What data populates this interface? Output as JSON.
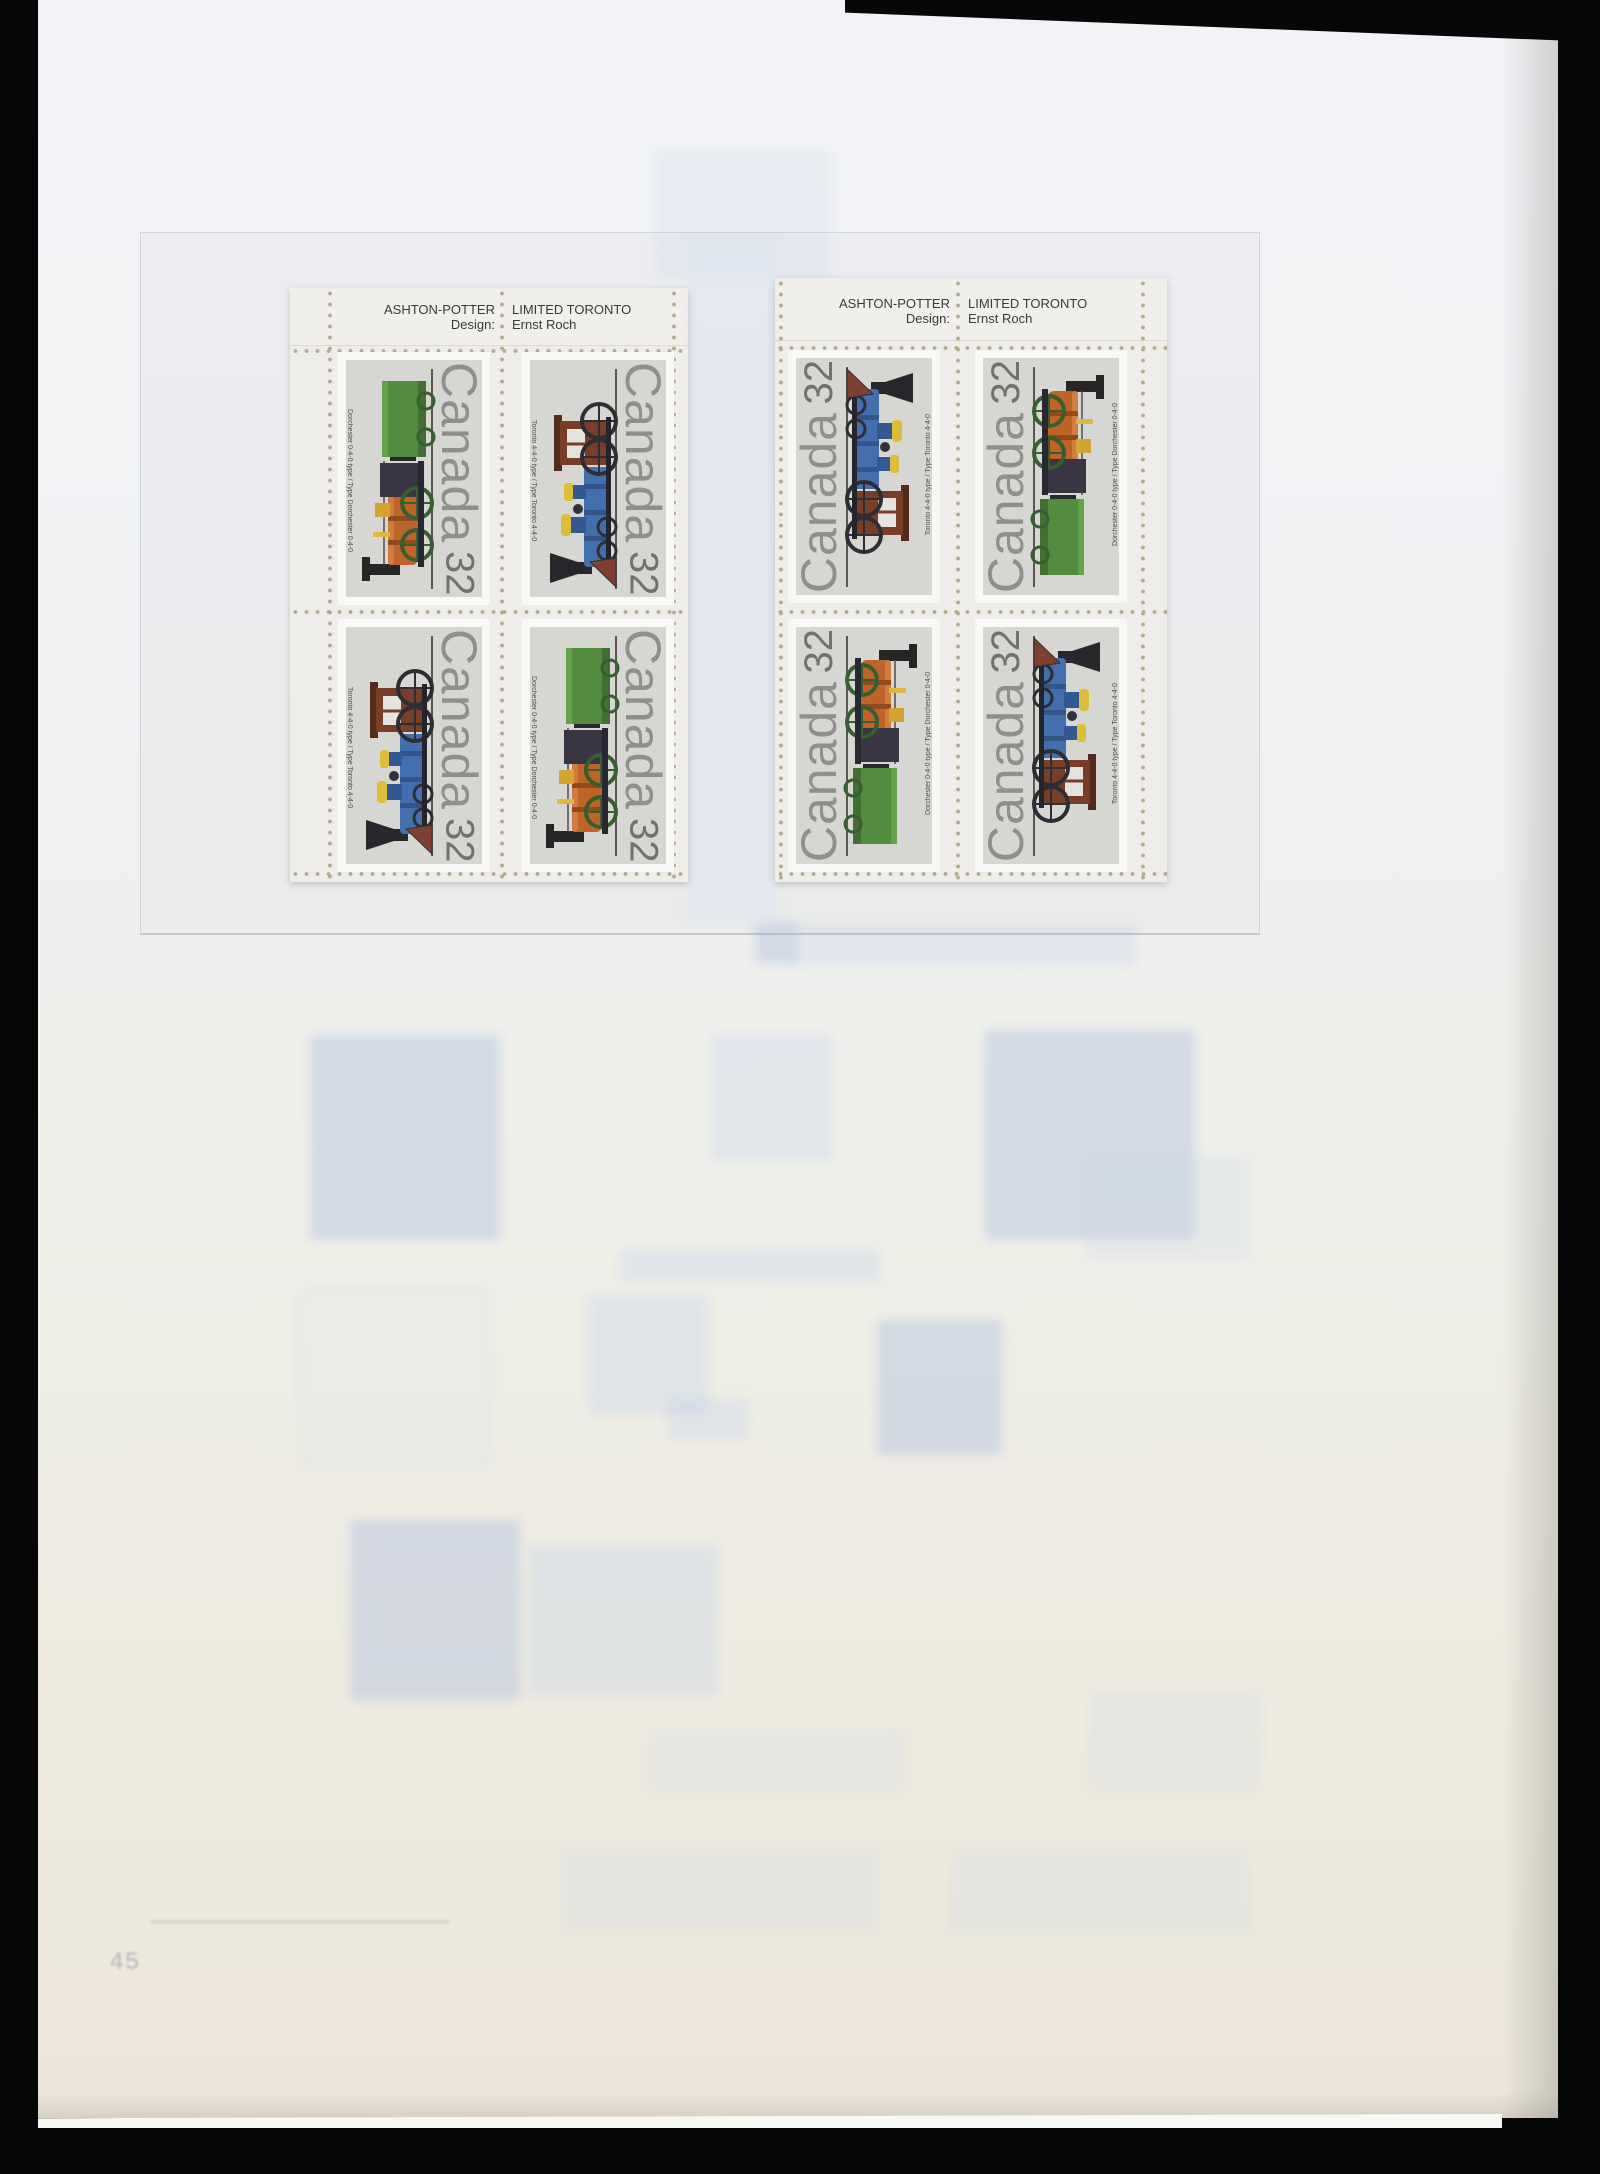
{
  "photo": {
    "description": "stamp album page with two plate blocks of Canada 32c locomotive stamps",
    "page_number": "45"
  },
  "imprint": {
    "printer": "ASHTON-POTTER",
    "printer2": "LIMITED TORONTO",
    "design_label": "Design:",
    "designer": "Ernst Roch"
  },
  "stamp": {
    "country": "Canada",
    "denomination": "32",
    "types": {
      "dorchester": {
        "name": "Dorchester 0-4-0",
        "caption": "Dorchester 0-4-0 type / Type Dorchester 0-4-0"
      },
      "toronto": {
        "name": "Toronto 4-4-0",
        "caption": "Toronto 4-4-0 type / Type Toronto 4-4-0"
      }
    }
  },
  "blocks": [
    {
      "id": "upper-left",
      "orientation": "stamps rotated 90deg clockwise",
      "grid": [
        [
          "dorchester",
          "toronto"
        ],
        [
          "toronto",
          "dorchester"
        ]
      ]
    },
    {
      "id": "upper-right",
      "orientation": "stamps rotated 90deg counter-clockwise",
      "grid": [
        [
          "toronto",
          "dorchester"
        ],
        [
          "dorchester",
          "toronto"
        ]
      ]
    }
  ],
  "colors": {
    "stamp_background": "#d9d9d4",
    "canada_text_gray": "#8e8e89",
    "toronto_blue": "#3e6cae",
    "toronto_cab_brown": "#76381f",
    "dorchester_orange": "#c06020",
    "tender_green": "#4e8a38",
    "dome_yellow": "#e2c030",
    "perforation_dot": "#b5ac8a",
    "album_page": "#efefe9",
    "scan_background": "#070707"
  }
}
